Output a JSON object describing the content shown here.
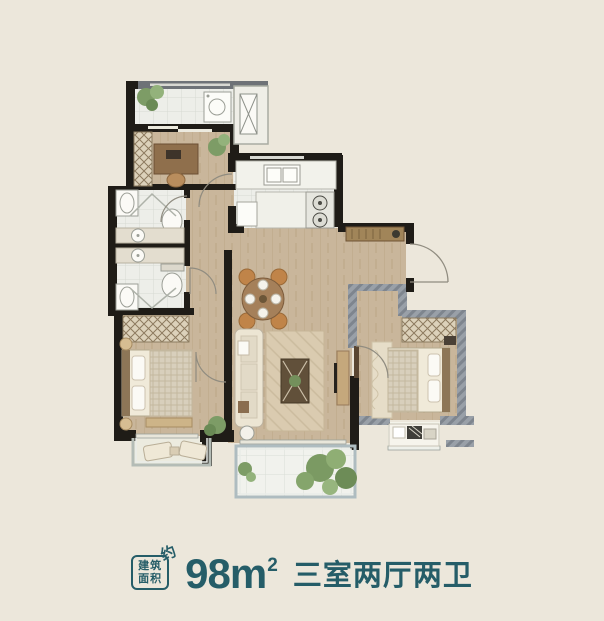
{
  "caption": {
    "stamp_line1": "建筑",
    "stamp_line2": "面积",
    "stamp_suffix": "约",
    "area_number": "98",
    "area_unit": "m",
    "area_exponent": "2",
    "layout_text": "三室两厅两卫"
  },
  "colors": {
    "background": "#ece7db",
    "accent_teal": "#255d68",
    "wall_black": "#1f1c17",
    "wall_gray": "#99a0a8",
    "wood_floor": "#c9b69b",
    "tile_floor": "#edeee9",
    "balcony_tile": "#f1f2ed",
    "furniture_tan": "#c5a87c",
    "plant_green": "#7d9c66"
  }
}
